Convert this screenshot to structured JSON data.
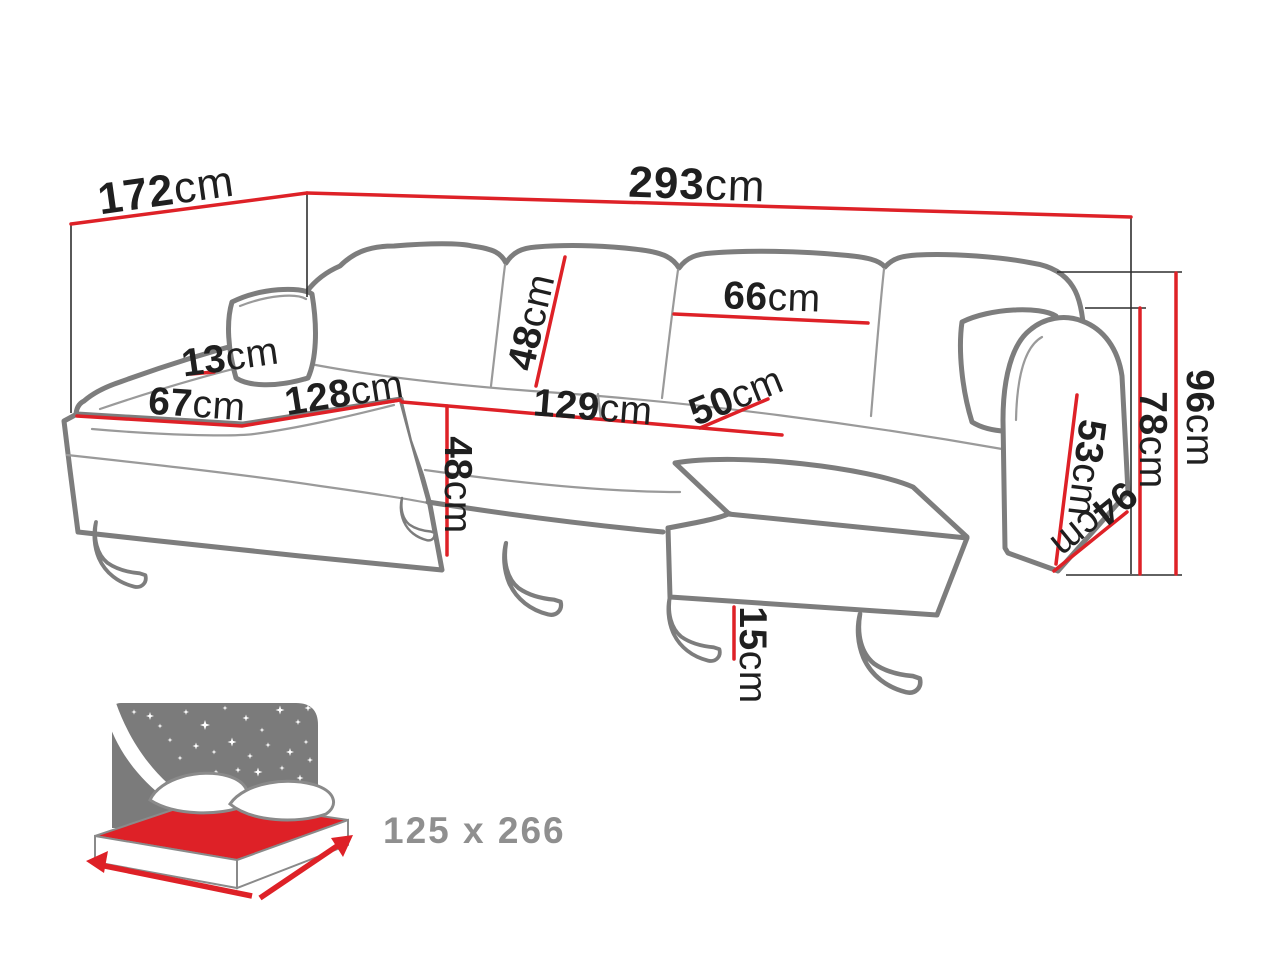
{
  "diagram": {
    "title": "corner-sofa-dimension-diagram",
    "unit_note": "all dimensions in centimetres",
    "dimensions": [
      {
        "id": "total-depth",
        "value": "172",
        "unit": "cm"
      },
      {
        "id": "total-width",
        "value": "293",
        "unit": "cm"
      },
      {
        "id": "back-cushion-width",
        "value": "66",
        "unit": "cm"
      },
      {
        "id": "back-cushion-height",
        "value": "48",
        "unit": "cm"
      },
      {
        "id": "armrest-top-thickness",
        "value": "13",
        "unit": "cm"
      },
      {
        "id": "chaise-front-width",
        "value": "67",
        "unit": "cm"
      },
      {
        "id": "chaise-length",
        "value": "128",
        "unit": "cm"
      },
      {
        "id": "seat-front-length",
        "value": "129",
        "unit": "cm"
      },
      {
        "id": "seat-depth",
        "value": "50",
        "unit": "cm"
      },
      {
        "id": "seat-height",
        "value": "48",
        "unit": "cm"
      },
      {
        "id": "arm-height-from-seat",
        "value": "53",
        "unit": "cm"
      },
      {
        "id": "arm-front-depth",
        "value": "94",
        "unit": "cm"
      },
      {
        "id": "armrest-height",
        "value": "78",
        "unit": "cm"
      },
      {
        "id": "total-height",
        "value": "96",
        "unit": "cm"
      },
      {
        "id": "leg-height",
        "value": "15",
        "unit": "cm"
      }
    ],
    "sleeping_area": {
      "label": "125 x 266"
    },
    "colors": {
      "dimension_red": "#de2127",
      "outline_gray": "#7d7d7d",
      "icon_gray": "#7b7b7b",
      "sleeping_label_gray": "#8f8f8f",
      "label_black": "#1f1f1f"
    },
    "icons": [
      "sleeping-function-bed-icon",
      "moon-crescent-icon",
      "star-icon",
      "arrow-icon"
    ]
  }
}
